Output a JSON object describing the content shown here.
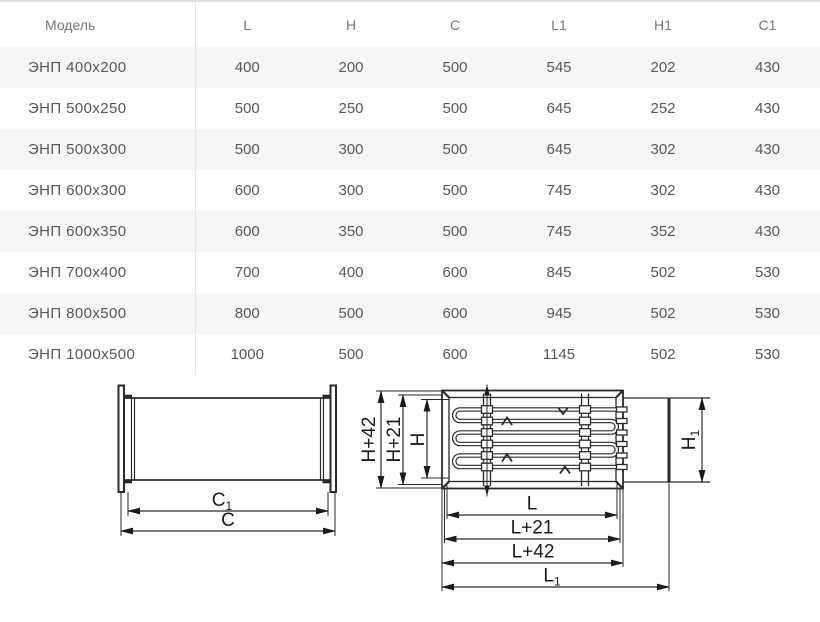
{
  "table": {
    "header": {
      "model": "Модель",
      "cols": [
        "L",
        "H",
        "C",
        "L1",
        "H1",
        "C1"
      ]
    },
    "rows": [
      [
        "ЭНП 400x200",
        "400",
        "200",
        "500",
        "545",
        "202",
        "430"
      ],
      [
        "ЭНП 500x250",
        "500",
        "250",
        "500",
        "645",
        "252",
        "430"
      ],
      [
        "ЭНП 500x300",
        "500",
        "300",
        "500",
        "645",
        "302",
        "430"
      ],
      [
        "ЭНП 600x300",
        "600",
        "300",
        "500",
        "745",
        "302",
        "430"
      ],
      [
        "ЭНП 600x350",
        "600",
        "350",
        "500",
        "745",
        "352",
        "430"
      ],
      [
        "ЭНП 700x400",
        "700",
        "400",
        "600",
        "845",
        "502",
        "530"
      ],
      [
        "ЭНП 800x500",
        "800",
        "500",
        "600",
        "945",
        "502",
        "530"
      ],
      [
        "ЭНП 1000x500",
        "1000",
        "500",
        "600",
        "1145",
        "502",
        "530"
      ]
    ],
    "colors": {
      "stripe": "#f6f6f7",
      "divider": "#e6e6e6",
      "top_border": "#e0e0e0",
      "header_text": "#75797e",
      "cell_text": "#55585c"
    }
  },
  "diagrams": {
    "side_view": {
      "dim_c1": {
        "main": "C",
        "sub": "1"
      },
      "dim_c": "C"
    },
    "front_view": {
      "dim_h42": "H+42",
      "dim_h21": "H+21",
      "dim_h": "H",
      "dim_h1": {
        "main": "H",
        "sub": "1"
      },
      "dim_l": "L",
      "dim_l21": "L+21",
      "dim_l42": "L+42",
      "dim_l1": {
        "main": "L",
        "sub": "1"
      }
    }
  }
}
